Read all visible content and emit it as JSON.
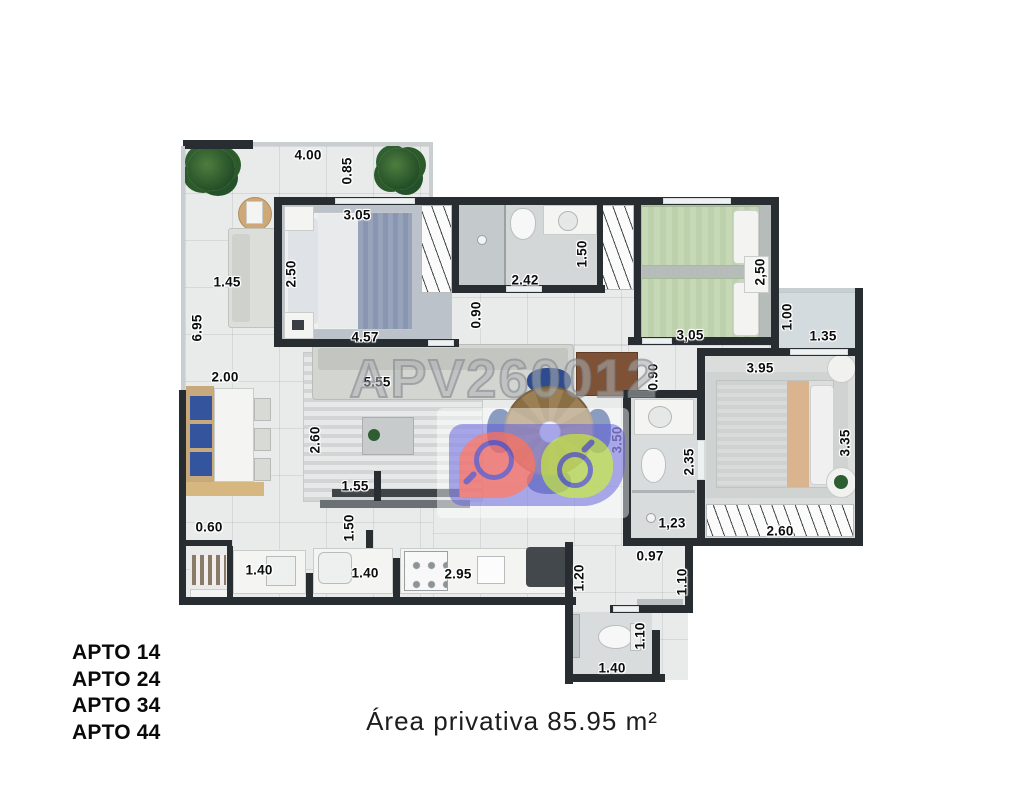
{
  "watermark": {
    "code": "APV260012"
  },
  "logo": {
    "colors": {
      "panel": "rgba(94,90,219,0.62)",
      "bubble": "#f3695f",
      "circle": "#bad84a",
      "glass": "#4646c8"
    }
  },
  "plan": {
    "dimensions": [
      {
        "value": "4.00",
        "x": 308,
        "y": 155,
        "vertical": false
      },
      {
        "value": "0.85",
        "x": 347,
        "y": 171,
        "vertical": true
      },
      {
        "value": "3.05",
        "x": 357,
        "y": 215,
        "vertical": false
      },
      {
        "value": "1.45",
        "x": 227,
        "y": 282,
        "vertical": false
      },
      {
        "value": "2.50",
        "x": 291,
        "y": 274,
        "vertical": true
      },
      {
        "value": "4.57",
        "x": 365,
        "y": 337,
        "vertical": false
      },
      {
        "value": "6.95",
        "x": 197,
        "y": 328,
        "vertical": true
      },
      {
        "value": "2.00",
        "x": 225,
        "y": 377,
        "vertical": false
      },
      {
        "value": "5.55",
        "x": 377,
        "y": 382,
        "vertical": false
      },
      {
        "value": "2.60",
        "x": 315,
        "y": 440,
        "vertical": true
      },
      {
        "value": "1.55",
        "x": 355,
        "y": 486,
        "vertical": false
      },
      {
        "value": "1.50",
        "x": 349,
        "y": 528,
        "vertical": true
      },
      {
        "value": "0.60",
        "x": 209,
        "y": 527,
        "vertical": false
      },
      {
        "value": "1.40",
        "x": 259,
        "y": 570,
        "vertical": false
      },
      {
        "value": "1.40",
        "x": 365,
        "y": 573,
        "vertical": false
      },
      {
        "value": "2.95",
        "x": 458,
        "y": 574,
        "vertical": false
      },
      {
        "value": "1.20",
        "x": 579,
        "y": 578,
        "vertical": true
      },
      {
        "value": "0.90",
        "x": 476,
        "y": 315,
        "vertical": true
      },
      {
        "value": "2.42",
        "x": 525,
        "y": 280,
        "vertical": false
      },
      {
        "value": "1.50",
        "x": 582,
        "y": 254,
        "vertical": true
      },
      {
        "value": "3,05",
        "x": 690,
        "y": 335,
        "vertical": false
      },
      {
        "value": "2,50",
        "x": 760,
        "y": 272,
        "vertical": true
      },
      {
        "value": "1.00",
        "x": 787,
        "y": 317,
        "vertical": true
      },
      {
        "value": "1.35",
        "x": 823,
        "y": 336,
        "vertical": false
      },
      {
        "value": "3.95",
        "x": 760,
        "y": 368,
        "vertical": false
      },
      {
        "value": "0.90",
        "x": 653,
        "y": 377,
        "vertical": true
      },
      {
        "value": "3.50",
        "x": 617,
        "y": 440,
        "vertical": true
      },
      {
        "value": "2.35",
        "x": 689,
        "y": 462,
        "vertical": true
      },
      {
        "value": "3.35",
        "x": 845,
        "y": 443,
        "vertical": true
      },
      {
        "value": "1,23",
        "x": 672,
        "y": 523,
        "vertical": false
      },
      {
        "value": "2.60",
        "x": 780,
        "y": 531,
        "vertical": false
      },
      {
        "value": "0.97",
        "x": 650,
        "y": 556,
        "vertical": false
      },
      {
        "value": "1.10",
        "x": 682,
        "y": 582,
        "vertical": true
      },
      {
        "value": "1.10",
        "x": 640,
        "y": 636,
        "vertical": true
      },
      {
        "value": "1.40",
        "x": 612,
        "y": 668,
        "vertical": false
      }
    ]
  },
  "footer": {
    "apartments": [
      "APTO 14",
      "APTO 24",
      "APTO 34",
      "APTO 44"
    ],
    "area_label": "Área privativa 85.95 m²",
    "area_value": "85.95",
    "area_unit": "m²"
  }
}
